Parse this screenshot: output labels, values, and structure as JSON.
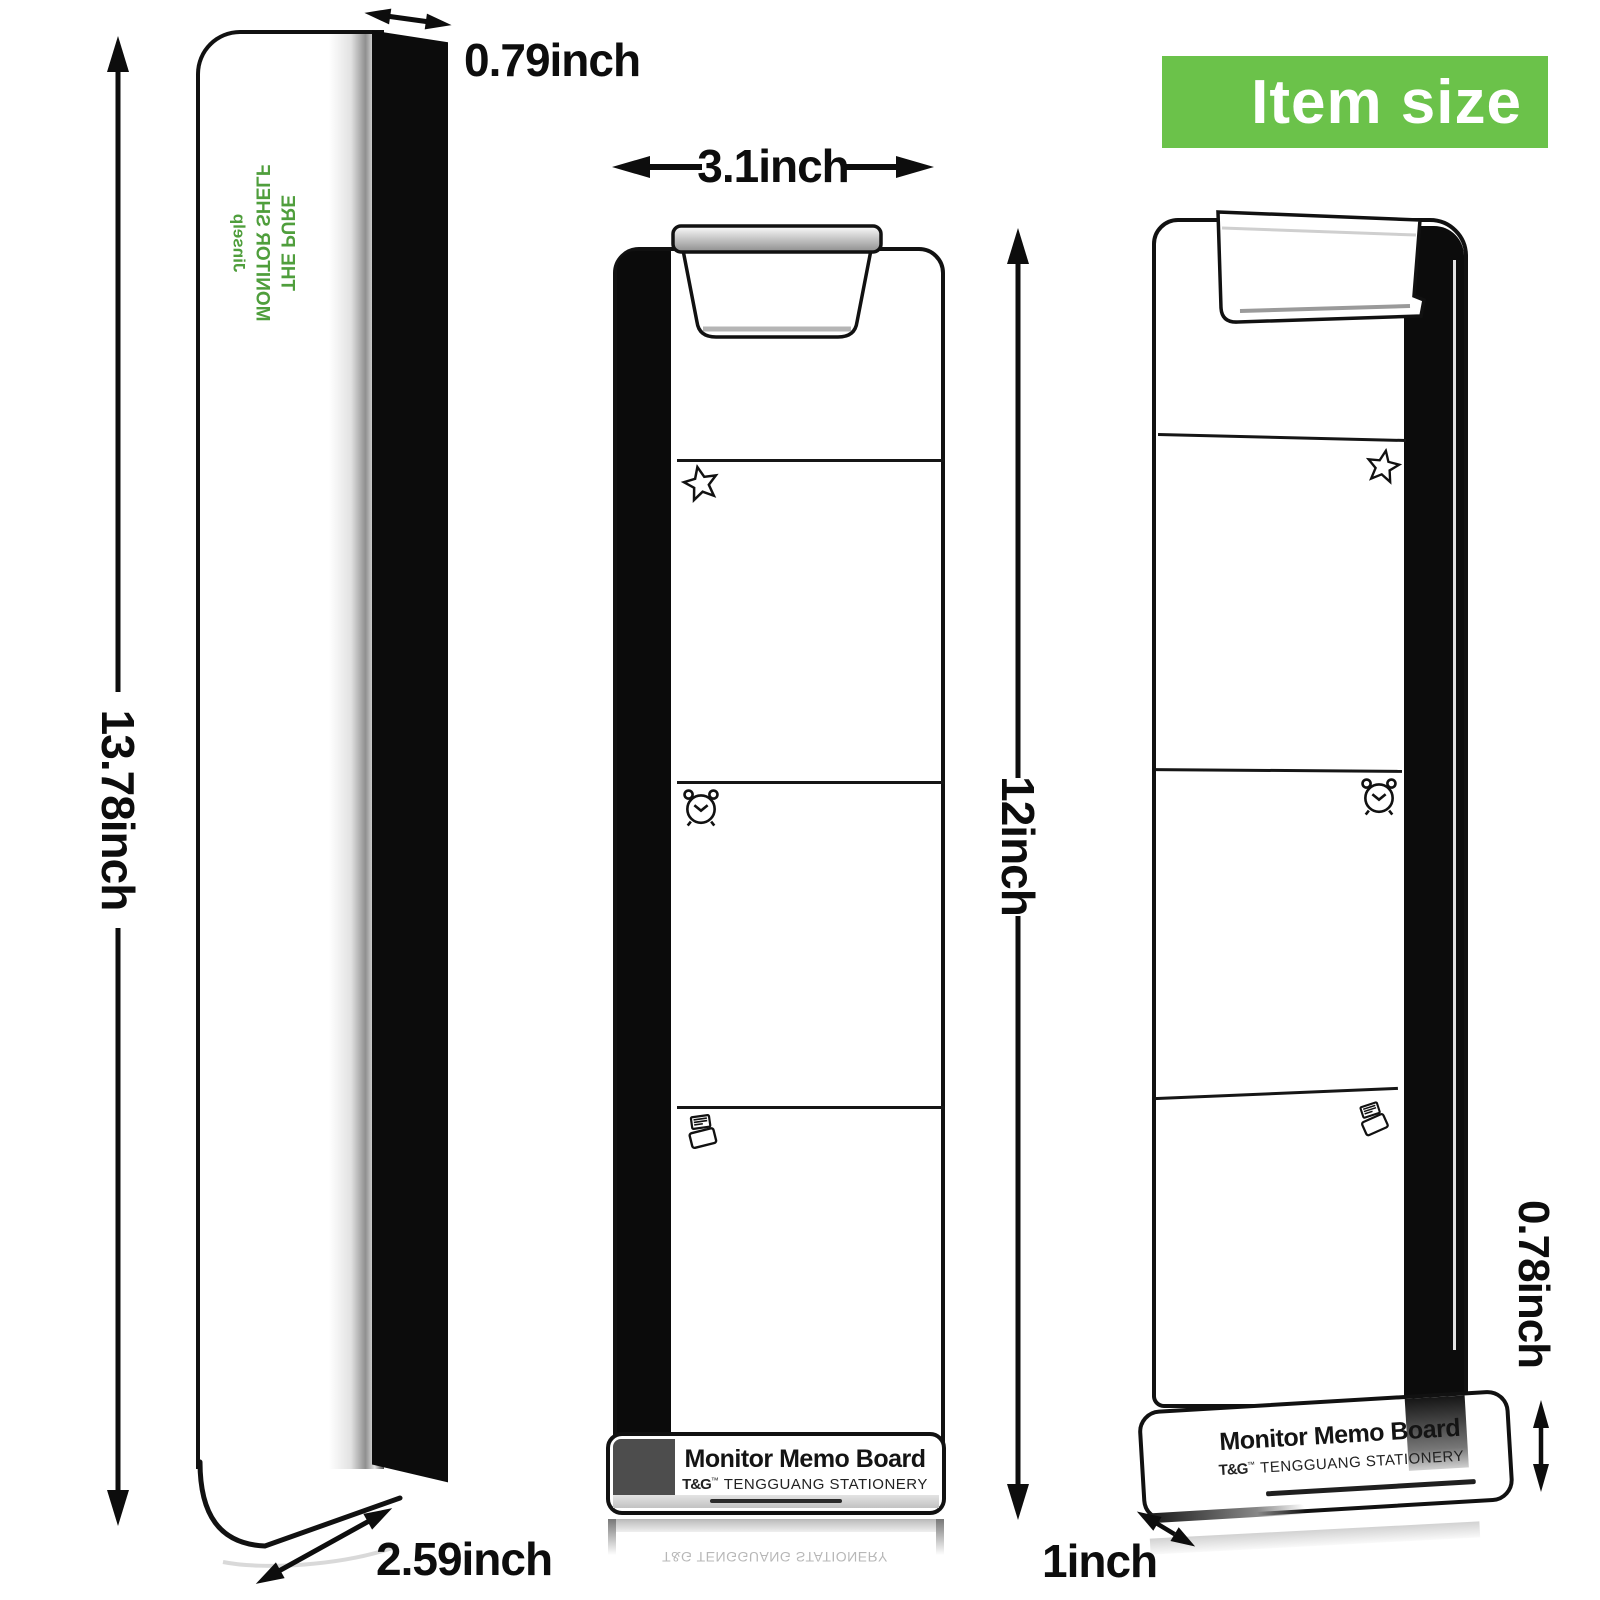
{
  "banner": {
    "label": "Item size"
  },
  "colors": {
    "banner_bg": "#6bc24a",
    "banner_text": "#ffffff",
    "panel_text": "#4f9e3c",
    "line": "#0d0d0d"
  },
  "side_view": {
    "height_label": "13.78inch",
    "top_depth_label": "0.79inch",
    "bottom_depth_label": "2.59inch",
    "panel_lines": [
      "THE PURE",
      "MONITOR SHELF",
      "Jinselp"
    ]
  },
  "front_view": {
    "width_label": "3.1inch",
    "height_label": "12inch",
    "icons": [
      "star-icon",
      "alarm-clock-icon",
      "message-icon"
    ],
    "tray": {
      "title": "Monitor Memo Board",
      "brand_logo": "T&G",
      "brand_tm": "™",
      "brand_name": "TENGGUANG STATIONERY"
    },
    "reflection_text": "T&G TENGGUANG STATIONERY"
  },
  "perspective_view": {
    "tray_height_label": "0.78inch",
    "base_depth_label": "1inch",
    "icons": [
      "star-icon",
      "alarm-clock-icon",
      "message-icon"
    ],
    "tray": {
      "title": "Monitor Memo Board",
      "brand_logo": "T&G",
      "brand_tm": "™",
      "brand_name": "TENGGUANG STATIONERY"
    }
  }
}
